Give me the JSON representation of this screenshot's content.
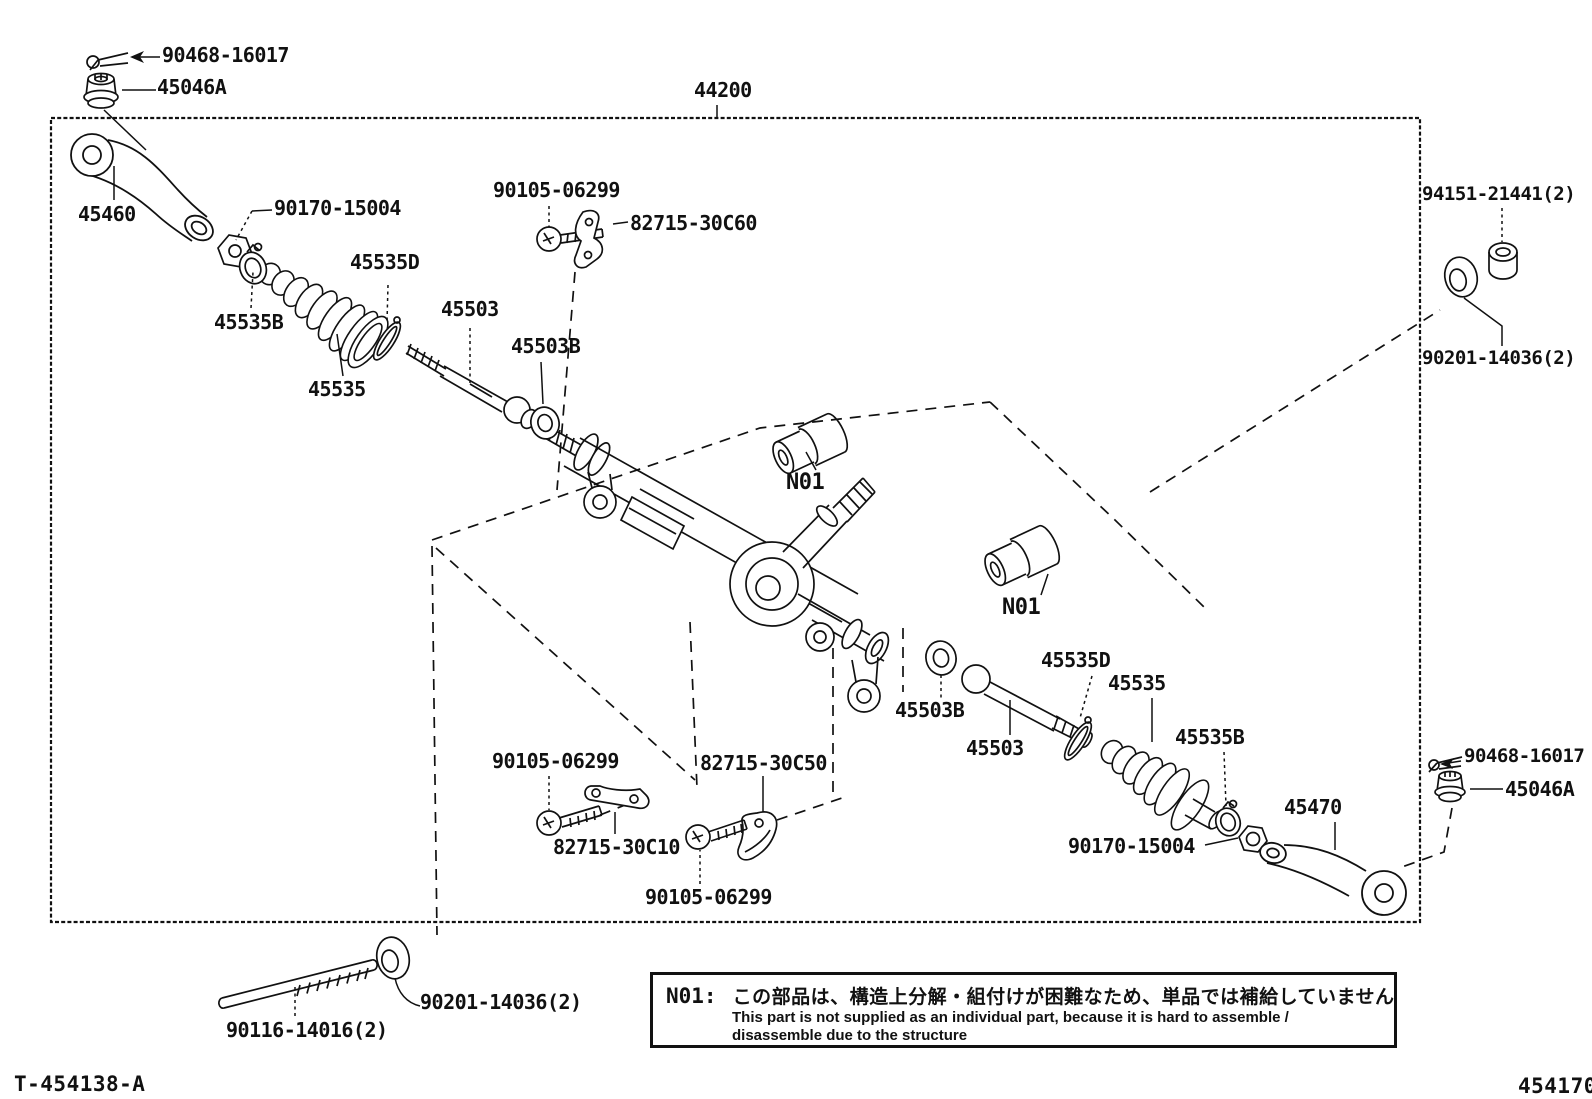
{
  "page": {
    "background": "#ffffff",
    "ink": "#111111"
  },
  "doc": {
    "drawing_code": "T-454138-A",
    "figure_code": "454170",
    "assembly_number": "44200"
  },
  "note": {
    "code": "N01:",
    "jp": "この部品は、構造上分解・組付けが困難なため、単品では補給していません",
    "en1": "This part is not supplied as an individual part, because it is hard to assemble /",
    "en2": "disassemble due to the structure"
  },
  "labels": [
    {
      "id": "cotter-pin-top",
      "text": "90468-16017",
      "x": 162,
      "y": 45
    },
    {
      "id": "grommet-top",
      "text": "45046A",
      "x": 157,
      "y": 77
    },
    {
      "id": "assembly-44200",
      "text": "44200",
      "x": 694,
      "y": 80
    },
    {
      "id": "arm-45460",
      "text": "45460",
      "x": 78,
      "y": 204
    },
    {
      "id": "nut-90170-left",
      "text": "90170-15004",
      "x": 274,
      "y": 198
    },
    {
      "id": "clamp-45535b-left",
      "text": "45535B",
      "x": 214,
      "y": 312
    },
    {
      "id": "boot-45535-left",
      "text": "45535",
      "x": 308,
      "y": 379
    },
    {
      "id": "oring-45535d-left",
      "text": "45535D",
      "x": 350,
      "y": 252
    },
    {
      "id": "tierod-45503-left",
      "text": "45503",
      "x": 441,
      "y": 299
    },
    {
      "id": "washer-45503b-left",
      "text": "45503B",
      "x": 511,
      "y": 336
    },
    {
      "id": "bolt-90105-top",
      "text": "90105-06299",
      "x": 493,
      "y": 180
    },
    {
      "id": "bracket-30c60",
      "text": "82715-30C60",
      "x": 630,
      "y": 213
    },
    {
      "id": "nut-94151",
      "text": "94151-21441(2)",
      "x": 1422,
      "y": 185,
      "fs": 19
    },
    {
      "id": "washer-90201-right",
      "text": "90201-14036(2)",
      "x": 1422,
      "y": 349,
      "fs": 19
    },
    {
      "id": "n01-a",
      "text": "N01",
      "x": 786,
      "y": 471,
      "fs": 22
    },
    {
      "id": "n01-b",
      "text": "N01",
      "x": 1002,
      "y": 596,
      "fs": 22
    },
    {
      "id": "washer-45503b-right",
      "text": "45503B",
      "x": 895,
      "y": 700
    },
    {
      "id": "tierod-45503-right",
      "text": "45503",
      "x": 966,
      "y": 738
    },
    {
      "id": "oring-45535d-right",
      "text": "45535D",
      "x": 1041,
      "y": 650
    },
    {
      "id": "boot-45535-right",
      "text": "45535",
      "x": 1108,
      "y": 673
    },
    {
      "id": "clamp-45535b-right",
      "text": "45535B",
      "x": 1175,
      "y": 727
    },
    {
      "id": "nut-90170-bottom",
      "text": "90170-15004",
      "x": 1068,
      "y": 836
    },
    {
      "id": "arm-45470",
      "text": "45470",
      "x": 1284,
      "y": 797
    },
    {
      "id": "cotter-pin-right",
      "text": "90468-16017",
      "x": 1464,
      "y": 747,
      "fs": 19
    },
    {
      "id": "grommet-right",
      "text": "45046A",
      "x": 1505,
      "y": 779
    },
    {
      "id": "bolt-90105-bl",
      "text": "90105-06299",
      "x": 492,
      "y": 751
    },
    {
      "id": "bracket-30c50",
      "text": "82715-30C50",
      "x": 700,
      "y": 753
    },
    {
      "id": "bracket-30c10",
      "text": "82715-30C10",
      "x": 553,
      "y": 837
    },
    {
      "id": "bolt-90105-bm",
      "text": "90105-06299",
      "x": 645,
      "y": 887
    },
    {
      "id": "stud-90116",
      "text": "90116-14016(2)",
      "x": 226,
      "y": 1020
    },
    {
      "id": "washer-90201-bottom",
      "text": "90201-14036(2)",
      "x": 420,
      "y": 992
    }
  ]
}
